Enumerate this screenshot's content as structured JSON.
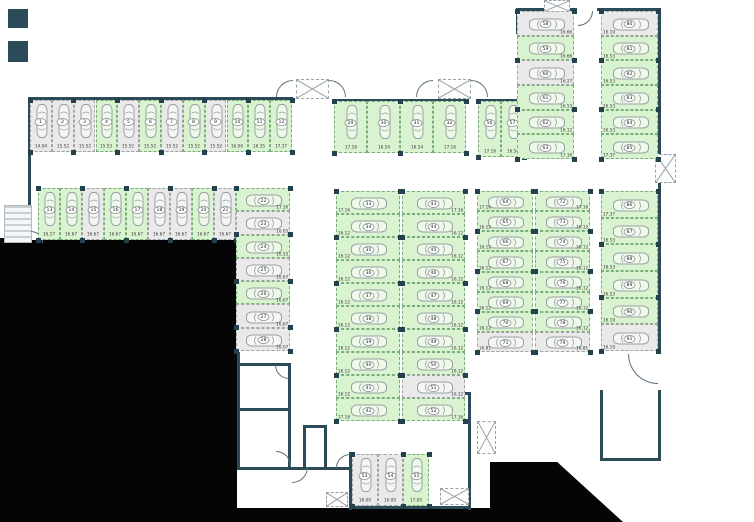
{
  "plan": {
    "kind": "parking-garage-floor-plan",
    "total_spaces": 91
  },
  "colors": {
    "available": "#d9f2cf",
    "available_border": "#79ad79",
    "occupied": "#e9e9e9",
    "occupied_border": "#a3a3a3",
    "wall": "#2b4b58",
    "void": "#050505",
    "car_outline": "#97a1a3"
  },
  "blocks": [
    {
      "id": "b1",
      "name": "north-west-row",
      "spaces": [
        {
          "n": "1",
          "st": "occupied",
          "m": "14.04"
        },
        {
          "n": "2",
          "st": "occupied",
          "m": "15.52"
        },
        {
          "n": "3",
          "st": "occupied",
          "m": "15.52"
        },
        {
          "n": "4",
          "st": "available",
          "m": "15.53"
        },
        {
          "n": "5",
          "st": "occupied",
          "m": "15.52"
        },
        {
          "n": "6",
          "st": "available",
          "m": "15.52"
        },
        {
          "n": "7",
          "st": "occupied",
          "m": "15.52"
        },
        {
          "n": "8",
          "st": "available",
          "m": "15.52"
        },
        {
          "n": "9",
          "st": "occupied",
          "m": "15.52"
        },
        {
          "n": "10",
          "st": "available",
          "m": "16.06"
        },
        {
          "n": "11",
          "st": "available",
          "m": "16.35"
        },
        {
          "n": "12",
          "st": "available",
          "m": "17.37"
        }
      ]
    },
    {
      "id": "b2",
      "name": "west-second-row",
      "spaces": [
        {
          "n": "13",
          "st": "available",
          "m": "16.27"
        },
        {
          "n": "14",
          "st": "available",
          "m": "16.67"
        },
        {
          "n": "15",
          "st": "occupied",
          "m": "16.67"
        },
        {
          "n": "16",
          "st": "available",
          "m": "16.67"
        },
        {
          "n": "17",
          "st": "available",
          "m": "16.67"
        },
        {
          "n": "18",
          "st": "occupied",
          "m": "16.67"
        },
        {
          "n": "19",
          "st": "occupied",
          "m": "16.67"
        },
        {
          "n": "20",
          "st": "available",
          "m": "16.67"
        },
        {
          "n": "21",
          "st": "occupied",
          "m": "16.67"
        }
      ]
    },
    {
      "id": "b3",
      "name": "west-stacked-column",
      "spaces": [
        {
          "n": "22",
          "st": "available",
          "m": "17.16"
        },
        {
          "n": "23",
          "st": "occupied",
          "m": "16.03"
        },
        {
          "n": "24",
          "st": "available",
          "m": "16.53"
        },
        {
          "n": "25",
          "st": "occupied",
          "m": "16.67"
        },
        {
          "n": "26",
          "st": "available",
          "m": "16.67"
        },
        {
          "n": "27",
          "st": "occupied",
          "m": "16.67"
        },
        {
          "n": "28",
          "st": "occupied",
          "m": "16.07"
        }
      ]
    },
    {
      "id": "b4",
      "name": "center-top-row",
      "spaces": [
        {
          "n": "29",
          "st": "available",
          "m": "17.16"
        },
        {
          "n": "30",
          "st": "available",
          "m": "16.54"
        },
        {
          "n": "31",
          "st": "available",
          "m": "16.54"
        },
        {
          "n": "32",
          "st": "available",
          "m": "17.16"
        }
      ]
    },
    {
      "id": "b5",
      "name": "center-top-row-east",
      "spaces": [
        {
          "n": "56",
          "st": "available",
          "m": "17.16"
        },
        {
          "n": "57",
          "st": "available",
          "m": "16.54"
        }
      ]
    },
    {
      "id": "b6",
      "name": "north-east-column-inner",
      "spaces": [
        {
          "n": "58",
          "st": "occupied",
          "m": "16.66"
        },
        {
          "n": "59",
          "st": "available",
          "m": "16.66"
        },
        {
          "n": "60",
          "st": "occupied",
          "m": "16.27"
        },
        {
          "n": "61",
          "st": "available",
          "m": "16.53"
        },
        {
          "n": "62",
          "st": "available",
          "m": "16.12"
        },
        {
          "n": "63",
          "st": "available",
          "m": "17.16"
        }
      ]
    },
    {
      "id": "b7",
      "name": "north-east-column-outer",
      "spaces": [
        {
          "n": "80",
          "st": "occupied",
          "m": "16.19"
        },
        {
          "n": "81",
          "st": "available",
          "m": "16.53"
        },
        {
          "n": "82",
          "st": "available",
          "m": "16.53"
        },
        {
          "n": "83",
          "st": "available",
          "m": "16.53"
        },
        {
          "n": "84",
          "st": "available",
          "m": "16.53"
        },
        {
          "n": "85",
          "st": "available",
          "m": "17.37"
        }
      ]
    },
    {
      "id": "b8",
      "name": "center-column-west",
      "spaces": [
        {
          "n": "33",
          "st": "available",
          "m": "17.16"
        },
        {
          "n": "34",
          "st": "available",
          "m": "16.12"
        },
        {
          "n": "35",
          "st": "available",
          "m": "16.12"
        },
        {
          "n": "36",
          "st": "available",
          "m": "16.12"
        },
        {
          "n": "37",
          "st": "available",
          "m": "16.12"
        },
        {
          "n": "38",
          "st": "available",
          "m": "16.12"
        },
        {
          "n": "39",
          "st": "available",
          "m": "16.12"
        },
        {
          "n": "40",
          "st": "available",
          "m": "16.12"
        },
        {
          "n": "41",
          "st": "available",
          "m": "16.12"
        },
        {
          "n": "42",
          "st": "available",
          "m": "17.16"
        }
      ]
    },
    {
      "id": "b9",
      "name": "center-column-east",
      "spaces": [
        {
          "n": "43",
          "st": "available",
          "m": "17.16"
        },
        {
          "n": "44",
          "st": "available",
          "m": "16.12"
        },
        {
          "n": "45",
          "st": "available",
          "m": "16.12"
        },
        {
          "n": "46",
          "st": "available",
          "m": "16.12"
        },
        {
          "n": "47",
          "st": "available",
          "m": "16.12"
        },
        {
          "n": "48",
          "st": "available",
          "m": "16.12"
        },
        {
          "n": "49",
          "st": "available",
          "m": "16.12"
        },
        {
          "n": "50",
          "st": "available",
          "m": "16.12"
        },
        {
          "n": "51",
          "st": "occupied",
          "m": "16.12"
        },
        {
          "n": "52",
          "st": "available",
          "m": "17.16"
        }
      ]
    },
    {
      "id": "b10",
      "name": "east-column-inner-west",
      "spaces": [
        {
          "n": "64",
          "st": "available",
          "m": "17.16"
        },
        {
          "n": "65",
          "st": "available",
          "m": "16.12"
        },
        {
          "n": "66",
          "st": "available",
          "m": "16.12"
        },
        {
          "n": "67",
          "st": "available",
          "m": "16.12"
        },
        {
          "n": "68",
          "st": "available",
          "m": "16.12"
        },
        {
          "n": "69",
          "st": "available",
          "m": "16.12"
        },
        {
          "n": "70",
          "st": "available",
          "m": "16.12"
        },
        {
          "n": "71",
          "st": "occupied",
          "m": "16.81"
        }
      ]
    },
    {
      "id": "b11",
      "name": "east-column-inner-east",
      "spaces": [
        {
          "n": "72",
          "st": "available",
          "m": "17.16"
        },
        {
          "n": "73",
          "st": "available",
          "m": "16.12"
        },
        {
          "n": "74",
          "st": "available",
          "m": "16.12"
        },
        {
          "n": "75",
          "st": "available",
          "m": "16.12"
        },
        {
          "n": "76",
          "st": "available",
          "m": "16.12"
        },
        {
          "n": "77",
          "st": "available",
          "m": "16.12"
        },
        {
          "n": "78",
          "st": "available",
          "m": "16.12"
        },
        {
          "n": "79",
          "st": "occupied",
          "m": "16.81"
        }
      ]
    },
    {
      "id": "b12",
      "name": "east-column-outer",
      "spaces": [
        {
          "n": "86",
          "st": "available",
          "m": "17.37"
        },
        {
          "n": "87",
          "st": "available",
          "m": "16.53"
        },
        {
          "n": "88",
          "st": "available",
          "m": "16.53"
        },
        {
          "n": "89",
          "st": "available",
          "m": "16.53"
        },
        {
          "n": "90",
          "st": "available",
          "m": "16.19"
        },
        {
          "n": "91",
          "st": "occupied",
          "m": "16.19"
        }
      ]
    },
    {
      "id": "b13",
      "name": "south-center-row",
      "spaces": [
        {
          "n": "53",
          "st": "occupied",
          "m": "16.00"
        },
        {
          "n": "54",
          "st": "occupied",
          "m": "16.00"
        },
        {
          "n": "55",
          "st": "available",
          "m": "17.00"
        }
      ]
    }
  ]
}
